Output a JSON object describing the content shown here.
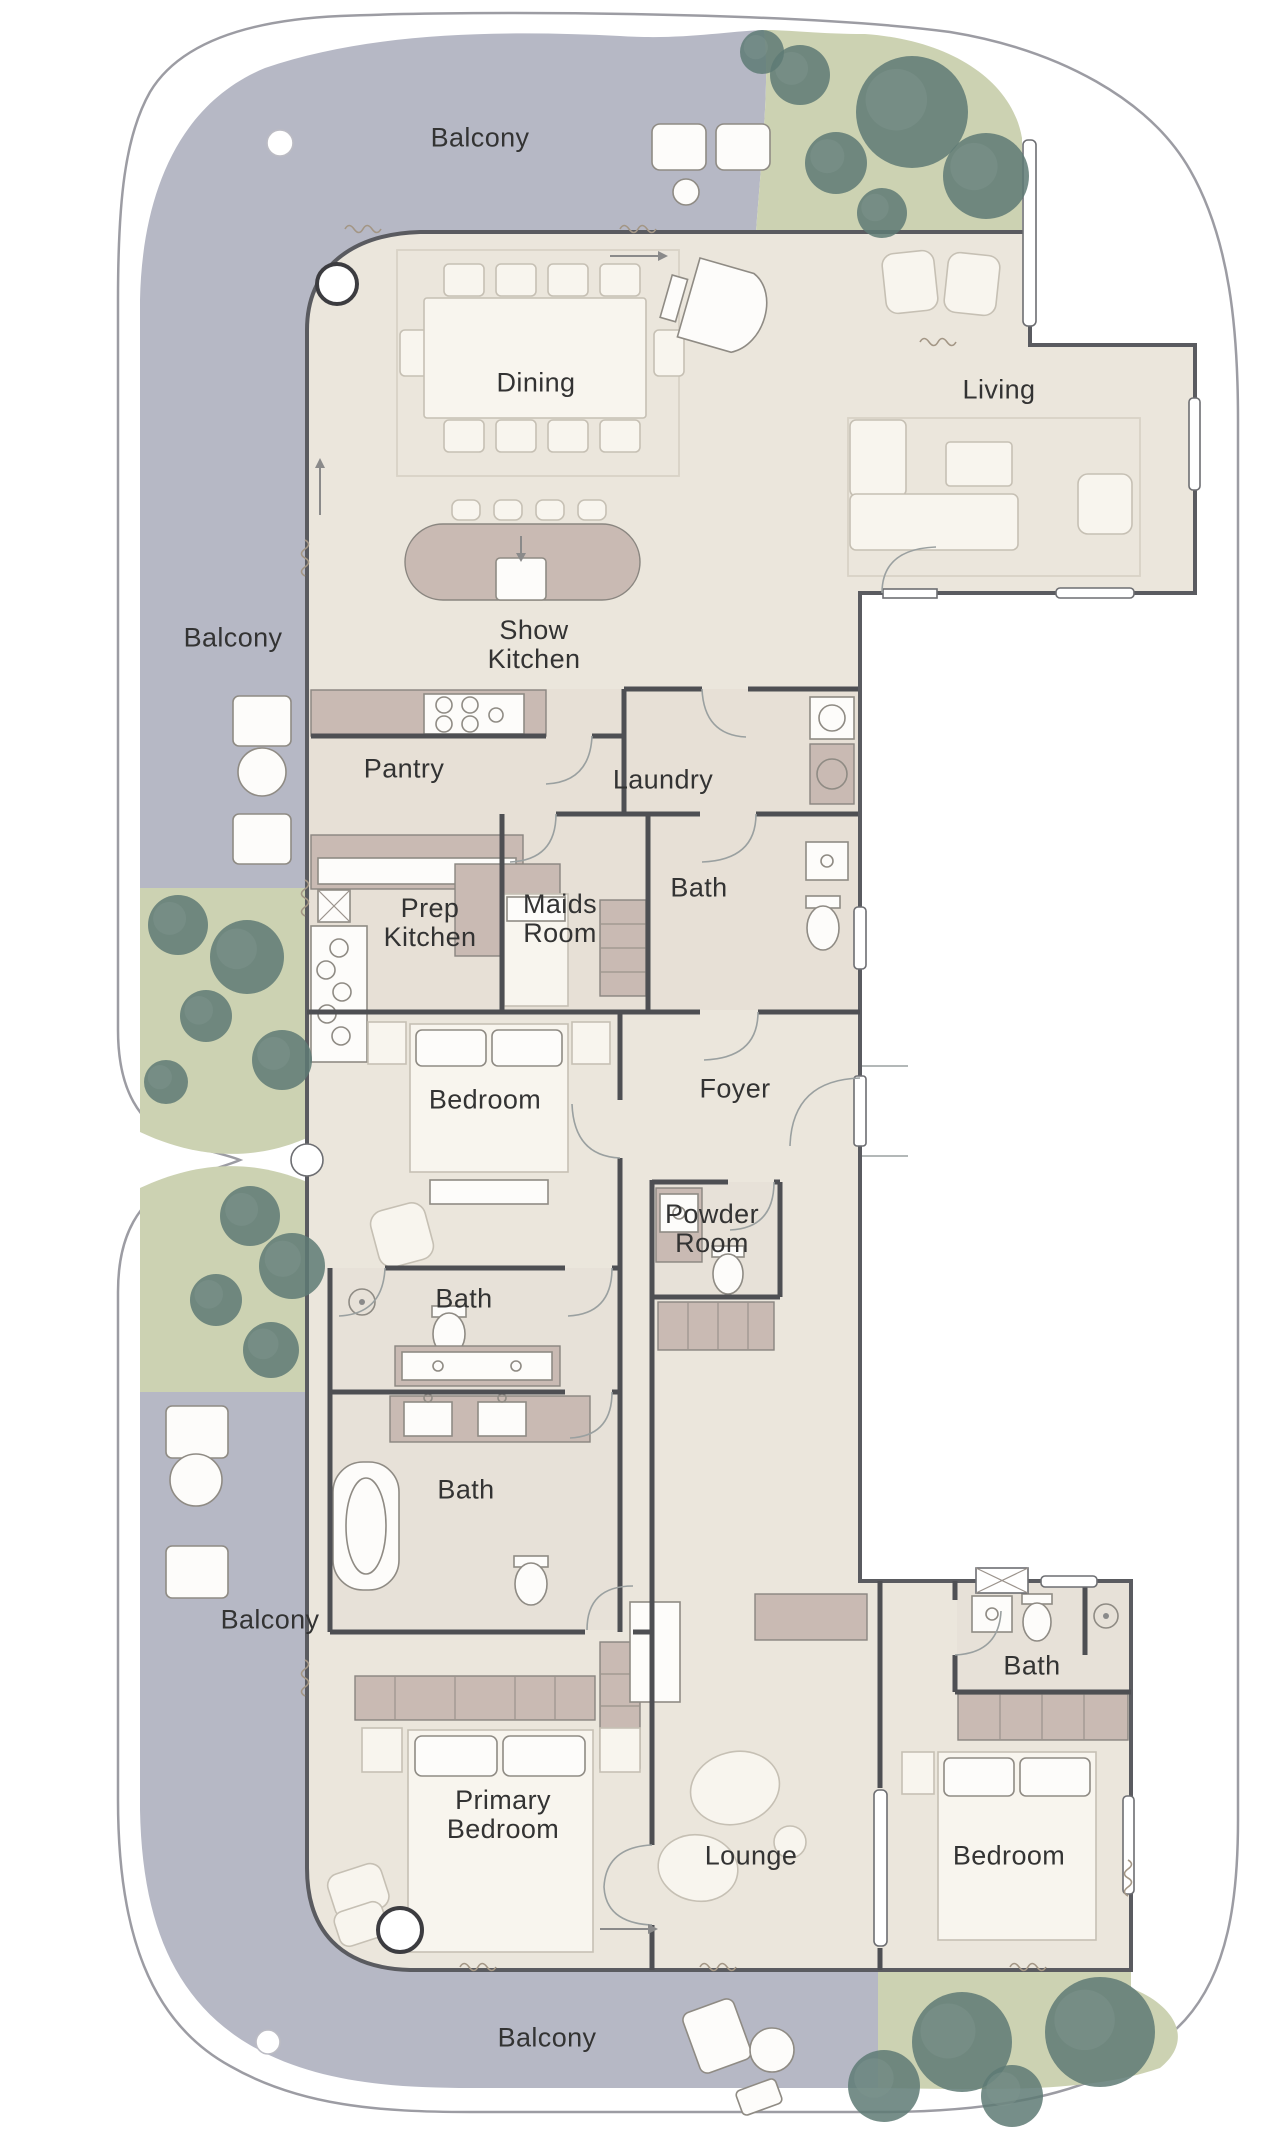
{
  "title": "Residence floor plan",
  "colors": {
    "balcony": "#b6b8c5",
    "floor": "#ebe6dc",
    "tint": "#e3dbd2",
    "wall": "#4e4f53",
    "counter": "#c9bab3",
    "green": "#ccd2b2",
    "tree": "#5e7a74",
    "furn": "#f8f5ee",
    "label": "#333333",
    "rim": "#9c9ca3"
  },
  "rooms": [
    {
      "label": "Balcony",
      "x": 480,
      "y": 138
    },
    {
      "label": "Dining",
      "x": 536,
      "y": 383
    },
    {
      "label": "Living",
      "x": 999,
      "y": 390
    },
    {
      "label": "Balcony",
      "x": 233,
      "y": 638
    },
    {
      "label": "Show\nKitchen",
      "x": 534,
      "y": 645
    },
    {
      "label": "Pantry",
      "x": 404,
      "y": 769
    },
    {
      "label": "Laundry",
      "x": 663,
      "y": 780
    },
    {
      "label": "Bath",
      "x": 699,
      "y": 888
    },
    {
      "label": "Prep\nKitchen",
      "x": 430,
      "y": 923
    },
    {
      "label": "Maids\nRoom",
      "x": 560,
      "y": 919
    },
    {
      "label": "Bedroom",
      "x": 485,
      "y": 1100
    },
    {
      "label": "Foyer",
      "x": 735,
      "y": 1089
    },
    {
      "label": "Powder\nRoom",
      "x": 712,
      "y": 1229
    },
    {
      "label": "Bath",
      "x": 464,
      "y": 1299
    },
    {
      "label": "Bath",
      "x": 466,
      "y": 1490
    },
    {
      "label": "Balcony",
      "x": 270,
      "y": 1620
    },
    {
      "label": "Primary\nBedroom",
      "x": 503,
      "y": 1815
    },
    {
      "label": "Lounge",
      "x": 751,
      "y": 1856
    },
    {
      "label": "Bedroom",
      "x": 1009,
      "y": 1856
    },
    {
      "label": "Bath",
      "x": 1032,
      "y": 1666
    },
    {
      "label": "Balcony",
      "x": 547,
      "y": 2038
    }
  ],
  "trees": [
    {
      "x": 800,
      "y": 75,
      "r": 30
    },
    {
      "x": 912,
      "y": 112,
      "r": 56
    },
    {
      "x": 836,
      "y": 163,
      "r": 31
    },
    {
      "x": 882,
      "y": 213,
      "r": 25
    },
    {
      "x": 986,
      "y": 176,
      "r": 43
    },
    {
      "x": 762,
      "y": 52,
      "r": 22
    },
    {
      "x": 178,
      "y": 925,
      "r": 30
    },
    {
      "x": 247,
      "y": 957,
      "r": 37
    },
    {
      "x": 206,
      "y": 1016,
      "r": 26
    },
    {
      "x": 282,
      "y": 1060,
      "r": 30
    },
    {
      "x": 166,
      "y": 1082,
      "r": 22
    },
    {
      "x": 250,
      "y": 1216,
      "r": 30
    },
    {
      "x": 292,
      "y": 1266,
      "r": 33
    },
    {
      "x": 216,
      "y": 1300,
      "r": 26
    },
    {
      "x": 271,
      "y": 1350,
      "r": 28
    },
    {
      "x": 962,
      "y": 2042,
      "r": 50
    },
    {
      "x": 1100,
      "y": 2032,
      "r": 55
    },
    {
      "x": 884,
      "y": 2086,
      "r": 36
    },
    {
      "x": 1012,
      "y": 2096,
      "r": 31
    }
  ],
  "columns": [
    {
      "x": 337,
      "y": 284,
      "r": 20,
      "ring": true
    },
    {
      "x": 400,
      "y": 1930,
      "r": 22,
      "ring": true
    },
    {
      "x": 280,
      "y": 143,
      "r": 13,
      "ring": false
    },
    {
      "x": 268,
      "y": 2042,
      "r": 12,
      "ring": false
    }
  ]
}
